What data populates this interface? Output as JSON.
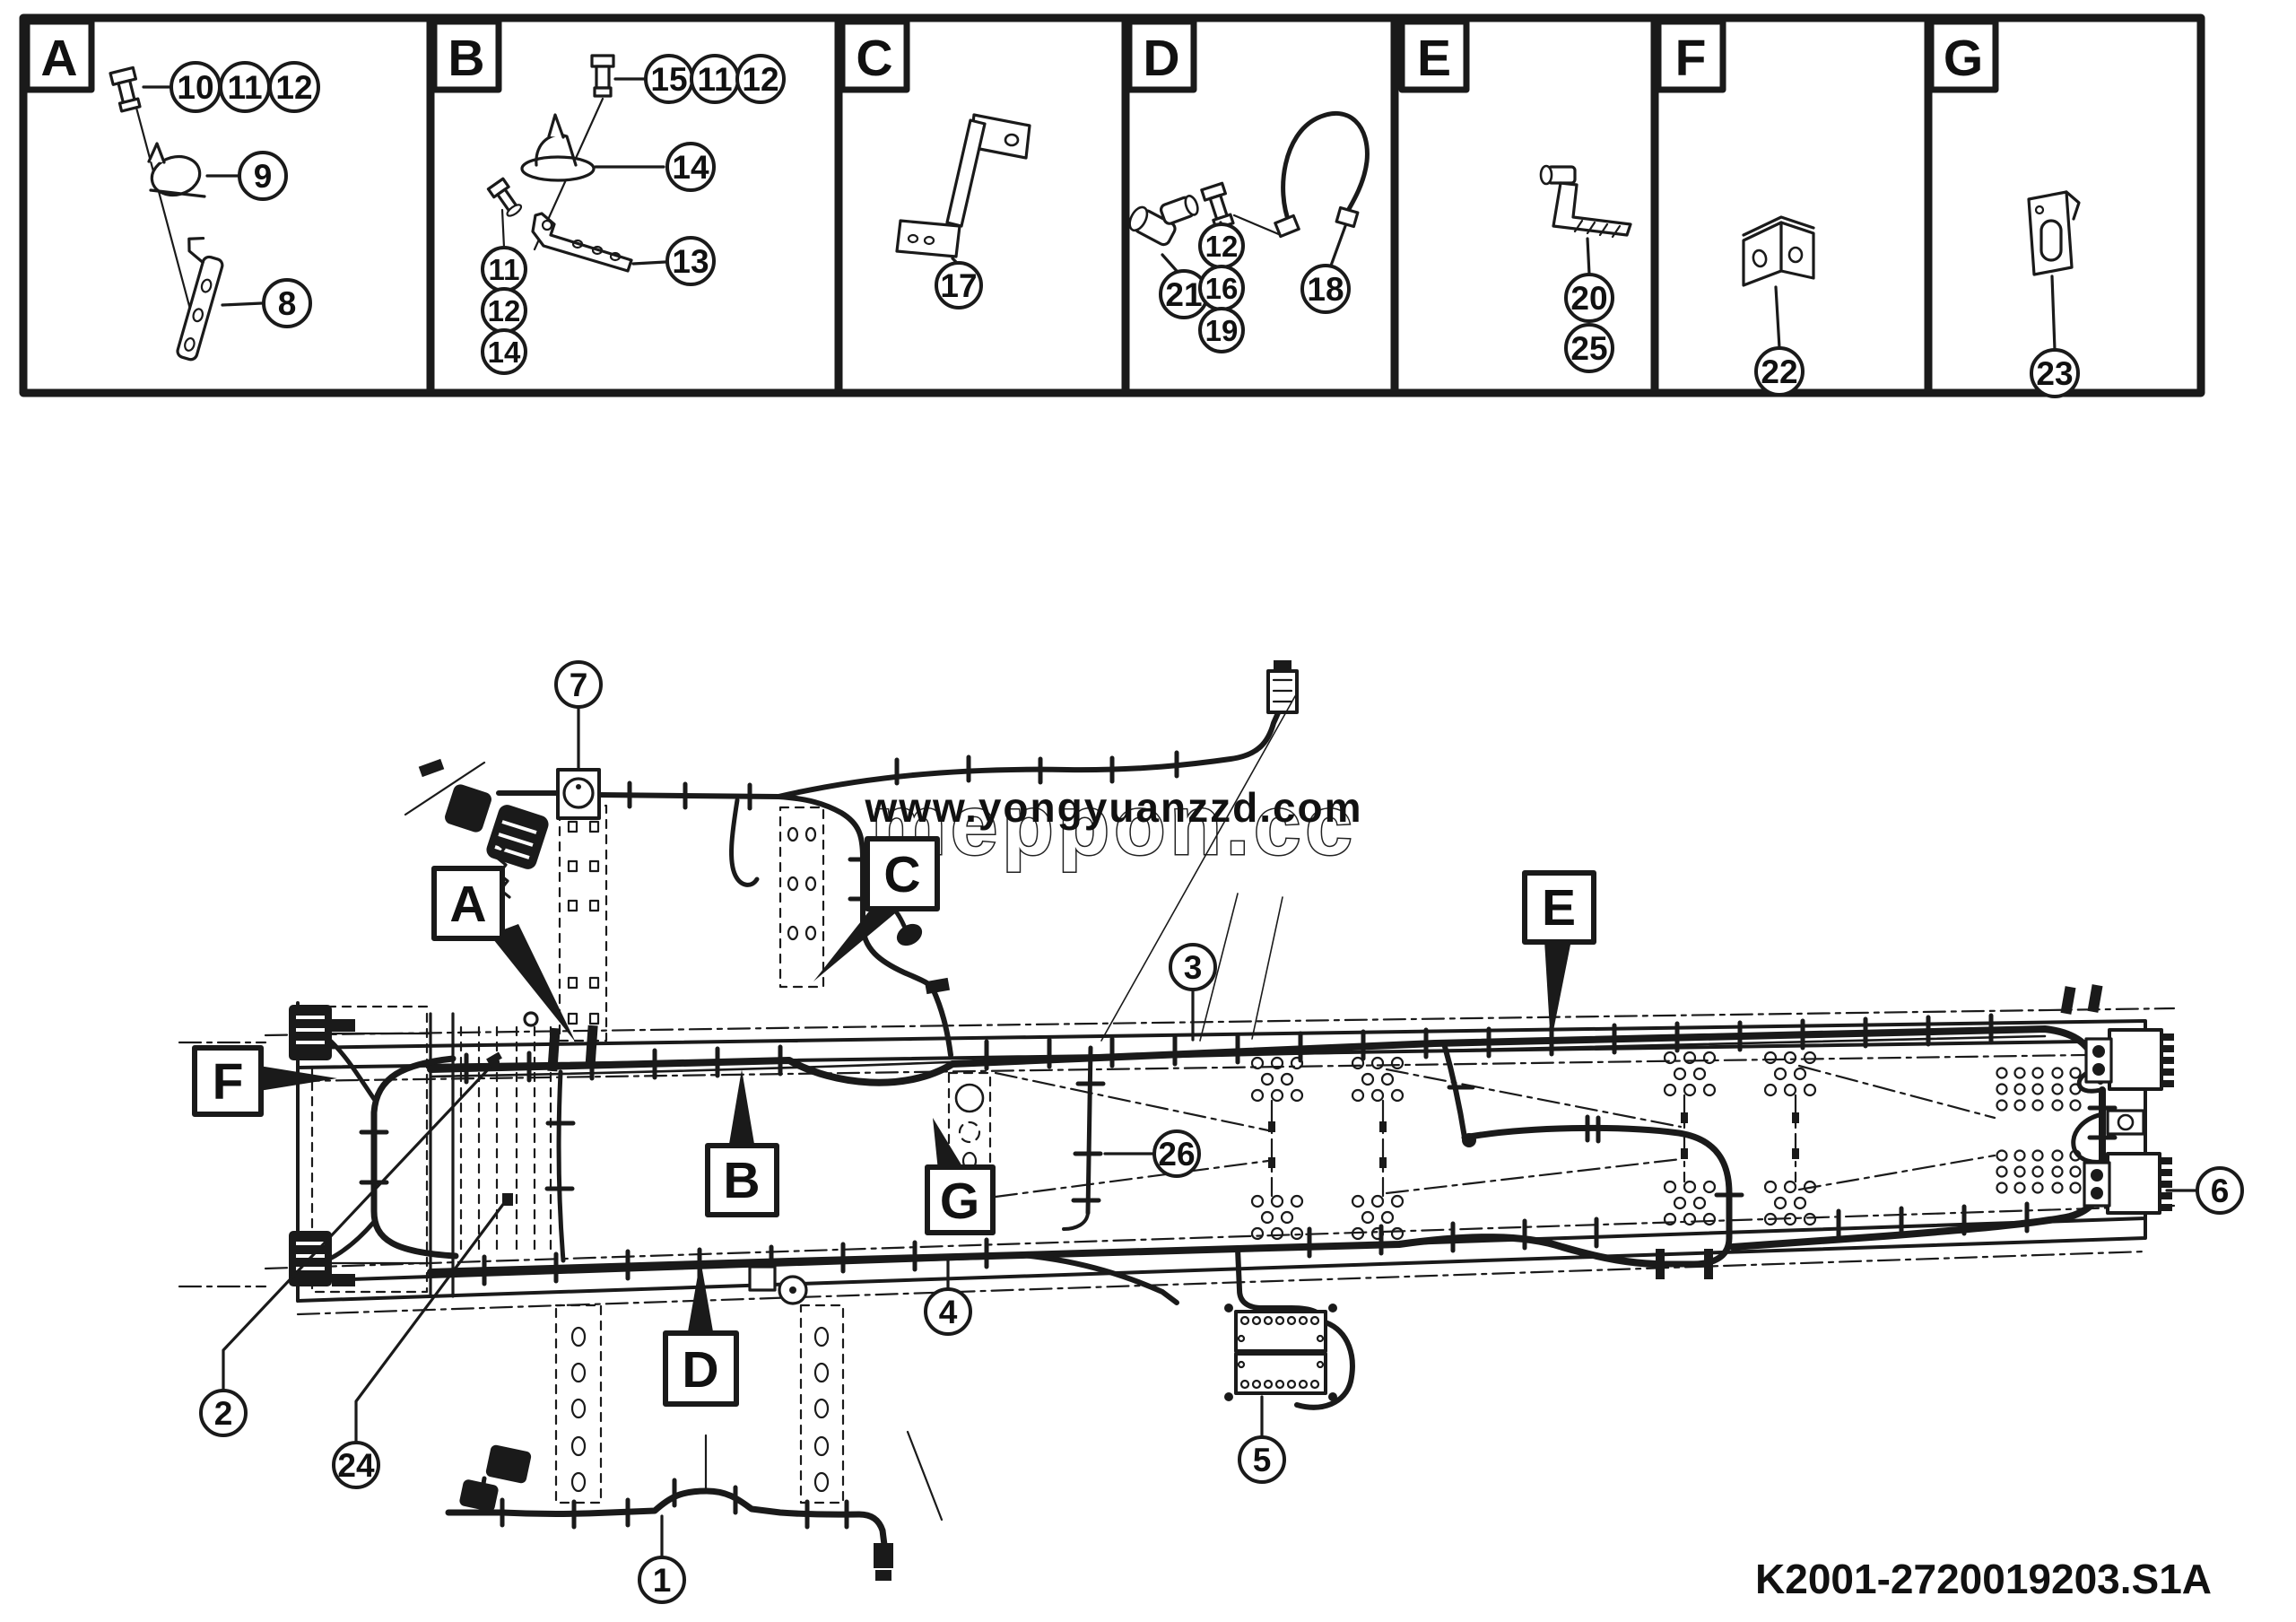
{
  "document": {
    "type": "chassis-wiring-harness-parts-diagram",
    "drawing_number": "K2001-2720019203.S1A",
    "background": "#ffffff",
    "line_color": "#1a1a1a"
  },
  "watermark": {
    "url_text": "www.yongyuanzzd.com",
    "url_color": "#2f79c6",
    "brand_text": "meppon.cc"
  },
  "letters": {
    "A": "A",
    "B": "B",
    "C": "C",
    "D": "D",
    "E": "E",
    "F": "F",
    "G": "G"
  },
  "numbers": {
    "n1": "1",
    "n2": "2",
    "n3": "3",
    "n4": "4",
    "n5": "5",
    "n6": "6",
    "n7": "7",
    "n8": "8",
    "n9": "9",
    "n10": "10",
    "n11": "11",
    "n12": "12",
    "n13": "13",
    "n14": "14",
    "n15": "15",
    "n16": "16",
    "n17": "17",
    "n18": "18",
    "n19": "19",
    "n20": "20",
    "n21": "21",
    "n22": "22",
    "n23": "23",
    "n24": "24",
    "n25": "25",
    "n26": "26"
  },
  "detail_panels": [
    {
      "letter": "A",
      "items": [
        {
          "part": "hex-bolt",
          "callouts": [
            "10",
            "11",
            "12"
          ]
        },
        {
          "part": "cable-clamp",
          "callouts": [
            "9"
          ]
        },
        {
          "part": "support-bracket",
          "callouts": [
            "8"
          ]
        }
      ]
    },
    {
      "letter": "B",
      "items": [
        {
          "part": "hex-bolt",
          "callouts": [
            "15",
            "11",
            "12"
          ]
        },
        {
          "part": "cable-clamp",
          "callouts": [
            "14"
          ]
        },
        {
          "part": "l-bracket",
          "callouts": [
            "13"
          ]
        },
        {
          "part": "hex-bolt",
          "callouts": [
            "11",
            "12",
            "14"
          ]
        }
      ]
    },
    {
      "letter": "C",
      "items": [
        {
          "part": "z-bracket",
          "callouts": [
            "17"
          ]
        }
      ]
    },
    {
      "letter": "D",
      "items": [
        {
          "part": "elbow-connector",
          "callouts": [
            "21"
          ]
        },
        {
          "part": "hex-bolt",
          "callouts": [
            "12",
            "16",
            "19"
          ]
        },
        {
          "part": "flexible-hose",
          "callouts": [
            "18"
          ]
        }
      ]
    },
    {
      "letter": "E",
      "items": [
        {
          "part": "clip-bracket",
          "callouts": [
            "20",
            "25"
          ]
        }
      ]
    },
    {
      "letter": "F",
      "items": [
        {
          "part": "angle-bracket",
          "callouts": [
            "22"
          ]
        }
      ]
    },
    {
      "letter": "G",
      "items": [
        {
          "part": "slotted-plate",
          "callouts": [
            "23"
          ]
        }
      ]
    }
  ],
  "main_view": {
    "subject": "chassis-frame-with-wiring-harness",
    "letter_markers": [
      "A",
      "B",
      "C",
      "D",
      "E",
      "F",
      "G"
    ],
    "number_markers": [
      "1",
      "2",
      "3",
      "4",
      "5",
      "6",
      "7",
      "24",
      "26"
    ]
  }
}
